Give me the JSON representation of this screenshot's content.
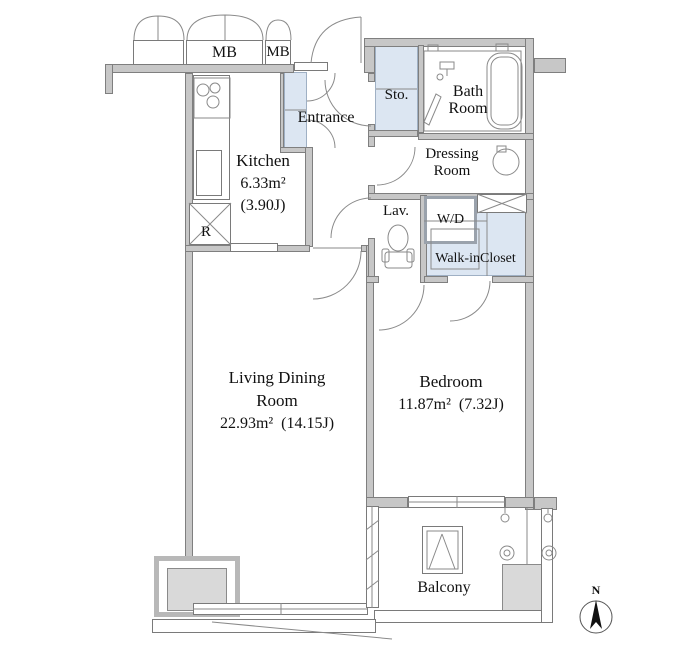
{
  "plan": {
    "rooms": {
      "kitchen": {
        "name": "Kitchen",
        "area_m2": "6.33m²",
        "area_jo": "(3.90J)"
      },
      "living": {
        "name_line1": "Living Dining",
        "name_line2": "Room",
        "area": "22.93m²  (14.15J)"
      },
      "bedroom": {
        "name": "Bedroom",
        "area": "11.87m²  (7.32J)"
      },
      "entrance": {
        "name": "Entrance"
      },
      "storage": {
        "name": "Sto."
      },
      "bath": {
        "name_line1": "Bath",
        "name_line2": "Room"
      },
      "dressing": {
        "name_line1": "Dressing",
        "name_line2": "Room"
      },
      "lavatory": {
        "name": "Lav."
      },
      "washer_dryer": {
        "name": "W/D"
      },
      "walk_in_closet": {
        "name": "Walk-inCloset"
      },
      "balcony": {
        "name": "Balcony"
      }
    },
    "labels": {
      "meter_box_1": "MB",
      "meter_box_2": "MB",
      "refrigerator": "R",
      "north": "N"
    },
    "colors": {
      "wall": "#c7c7c7",
      "wall_edge": "#7f7f7f",
      "fixture_blue": "#dce6f2",
      "unit_gray": "#d9d9d9",
      "line": "#8a8a8a",
      "text": "#111111"
    }
  }
}
